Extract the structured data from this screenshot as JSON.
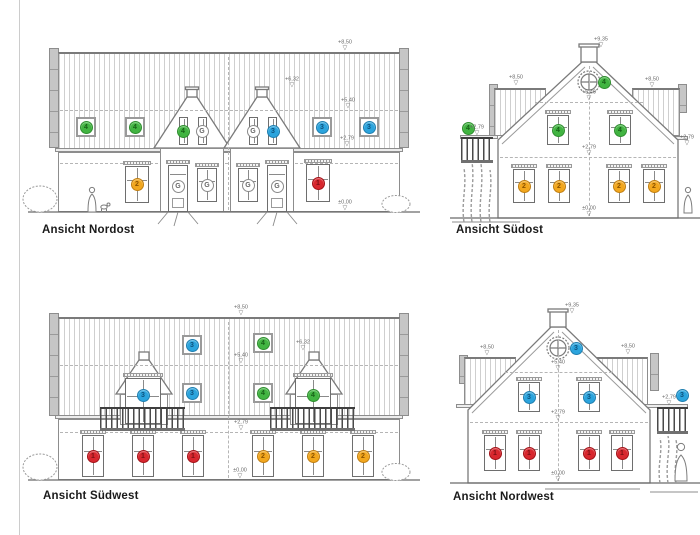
{
  "sheet": {
    "background": "#ffffff",
    "border_color": "#cccccc"
  },
  "marker_styles": {
    "1": {
      "bg": "#d8272e",
      "bd": "#a31218",
      "fg": "#7a1014"
    },
    "2": {
      "bg": "#f2a71e",
      "bd": "#c07f12",
      "fg": "#8a5200"
    },
    "3": {
      "bg": "#2ba4dd",
      "bd": "#1f7fb0",
      "fg": "#0e537d"
    },
    "4": {
      "bg": "#41b441",
      "bd": "#2f8f2f",
      "fg": "#176117"
    },
    "G": {
      "bg": "#ffffff",
      "bd": "#8a8a8a",
      "fg": "#666666"
    }
  },
  "elevations": [
    {
      "id": "nordost",
      "label": "Ansicht Nordost",
      "markers": [
        {
          "n": "4",
          "x": 86,
          "y": 127,
          "frame": true
        },
        {
          "n": "4",
          "x": 135,
          "y": 127,
          "frame": true
        },
        {
          "n": "4",
          "x": 183,
          "y": 131
        },
        {
          "n": "G",
          "x": 202,
          "y": 131
        },
        {
          "n": "G",
          "x": 253,
          "y": 131
        },
        {
          "n": "3",
          "x": 273,
          "y": 131
        },
        {
          "n": "3",
          "x": 322,
          "y": 127,
          "frame": true
        },
        {
          "n": "3",
          "x": 369,
          "y": 127,
          "frame": true
        },
        {
          "n": "2",
          "x": 137,
          "y": 184
        },
        {
          "n": "G",
          "x": 178,
          "y": 186
        },
        {
          "n": "G",
          "x": 207,
          "y": 185
        },
        {
          "n": "G",
          "x": 248,
          "y": 185
        },
        {
          "n": "G",
          "x": 277,
          "y": 186
        },
        {
          "n": "1",
          "x": 318,
          "y": 183
        }
      ],
      "levels": [
        {
          "t": "+8,50",
          "x": 345,
          "y": 51
        },
        {
          "t": "+6,32",
          "x": 292,
          "y": 88
        },
        {
          "t": "+5,40",
          "x": 348,
          "y": 109
        },
        {
          "t": "+2,79",
          "x": 347,
          "y": 147
        },
        {
          "t": "±0,00",
          "x": 345,
          "y": 211
        }
      ]
    },
    {
      "id": "suedost",
      "label": "Ansicht Südost",
      "markers": [
        {
          "n": "4",
          "x": 468,
          "y": 128
        },
        {
          "n": "4",
          "x": 604,
          "y": 82
        },
        {
          "n": "4",
          "x": 558,
          "y": 130
        },
        {
          "n": "4",
          "x": 620,
          "y": 130
        },
        {
          "n": "2",
          "x": 524,
          "y": 186
        },
        {
          "n": "2",
          "x": 559,
          "y": 186
        },
        {
          "n": "2",
          "x": 619,
          "y": 186
        },
        {
          "n": "2",
          "x": 654,
          "y": 186
        }
      ],
      "levels": [
        {
          "t": "+9,35",
          "x": 601,
          "y": 48
        },
        {
          "t": "+8,50",
          "x": 516,
          "y": 86
        },
        {
          "t": "+8,50",
          "x": 652,
          "y": 88
        },
        {
          "t": "+5,40",
          "x": 589,
          "y": 101
        },
        {
          "t": "+2,79",
          "x": 477,
          "y": 136
        },
        {
          "t": "+2,79",
          "x": 589,
          "y": 156
        },
        {
          "t": "+2,79",
          "x": 687,
          "y": 146
        },
        {
          "t": "±0,00",
          "x": 589,
          "y": 217
        }
      ]
    },
    {
      "id": "suedwest",
      "label": "Ansicht Südwest",
      "markers": [
        {
          "n": "3",
          "x": 192,
          "y": 345,
          "frame": true
        },
        {
          "n": "4",
          "x": 263,
          "y": 343,
          "frame": true
        },
        {
          "n": "3",
          "x": 143,
          "y": 395
        },
        {
          "n": "3",
          "x": 192,
          "y": 393,
          "frame": true
        },
        {
          "n": "4",
          "x": 263,
          "y": 393,
          "frame": true
        },
        {
          "n": "4",
          "x": 313,
          "y": 395
        },
        {
          "n": "1",
          "x": 93,
          "y": 456
        },
        {
          "n": "1",
          "x": 143,
          "y": 456
        },
        {
          "n": "1",
          "x": 193,
          "y": 456
        },
        {
          "n": "2",
          "x": 263,
          "y": 456
        },
        {
          "n": "2",
          "x": 313,
          "y": 456
        },
        {
          "n": "2",
          "x": 363,
          "y": 456
        }
      ],
      "levels": [
        {
          "t": "+8,50",
          "x": 241,
          "y": 316
        },
        {
          "t": "+6,32",
          "x": 303,
          "y": 351
        },
        {
          "t": "+5,40",
          "x": 241,
          "y": 364
        },
        {
          "t": "+2,79",
          "x": 241,
          "y": 431
        },
        {
          "t": "±0,00",
          "x": 240,
          "y": 479
        }
      ]
    },
    {
      "id": "nordwest",
      "label": "Ansicht Nordwest",
      "markers": [
        {
          "n": "3",
          "x": 576,
          "y": 348
        },
        {
          "n": "3",
          "x": 529,
          "y": 397
        },
        {
          "n": "3",
          "x": 589,
          "y": 397
        },
        {
          "n": "3",
          "x": 682,
          "y": 395
        },
        {
          "n": "1",
          "x": 495,
          "y": 453
        },
        {
          "n": "1",
          "x": 529,
          "y": 453
        },
        {
          "n": "1",
          "x": 589,
          "y": 453
        },
        {
          "n": "1",
          "x": 622,
          "y": 453
        }
      ],
      "levels": [
        {
          "t": "+9,35",
          "x": 572,
          "y": 314
        },
        {
          "t": "+8,50",
          "x": 487,
          "y": 356
        },
        {
          "t": "+8,50",
          "x": 628,
          "y": 355
        },
        {
          "t": "+5,40",
          "x": 558,
          "y": 371
        },
        {
          "t": "+2,79",
          "x": 558,
          "y": 421
        },
        {
          "t": "+2,79",
          "x": 669,
          "y": 406
        },
        {
          "t": "±0,00",
          "x": 558,
          "y": 482
        }
      ]
    }
  ]
}
